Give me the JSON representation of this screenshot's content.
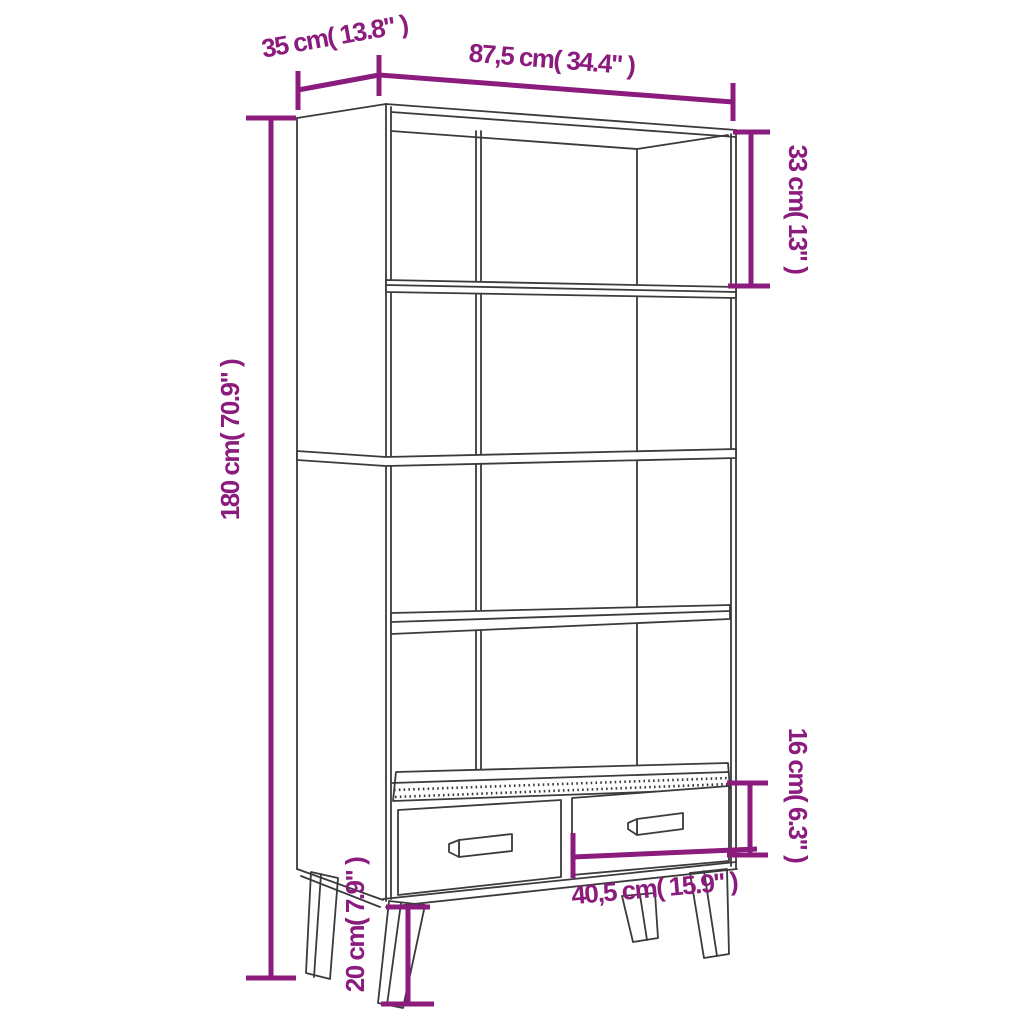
{
  "diagram": {
    "kind": "furniture dimension drawing",
    "subject": "bookcase with four open shelves, two drawers and splayed legs"
  },
  "colors": {
    "dimension": "#8B1B7D",
    "line": "#3B3B3B",
    "background": "#FFFFFF"
  },
  "dims": {
    "depth": "35 cm( 13.8\" )",
    "width": "87,5 cm( 34.4\" )",
    "top_shelf_height": "33 cm( 13\" )",
    "total_height": "180 cm( 70.9\" )",
    "drawer_height": "16 cm( 6.3\" )",
    "drawer_width": "40,5 cm( 15.9\" )",
    "leg_height": "20 cm( 7.9\" )"
  }
}
